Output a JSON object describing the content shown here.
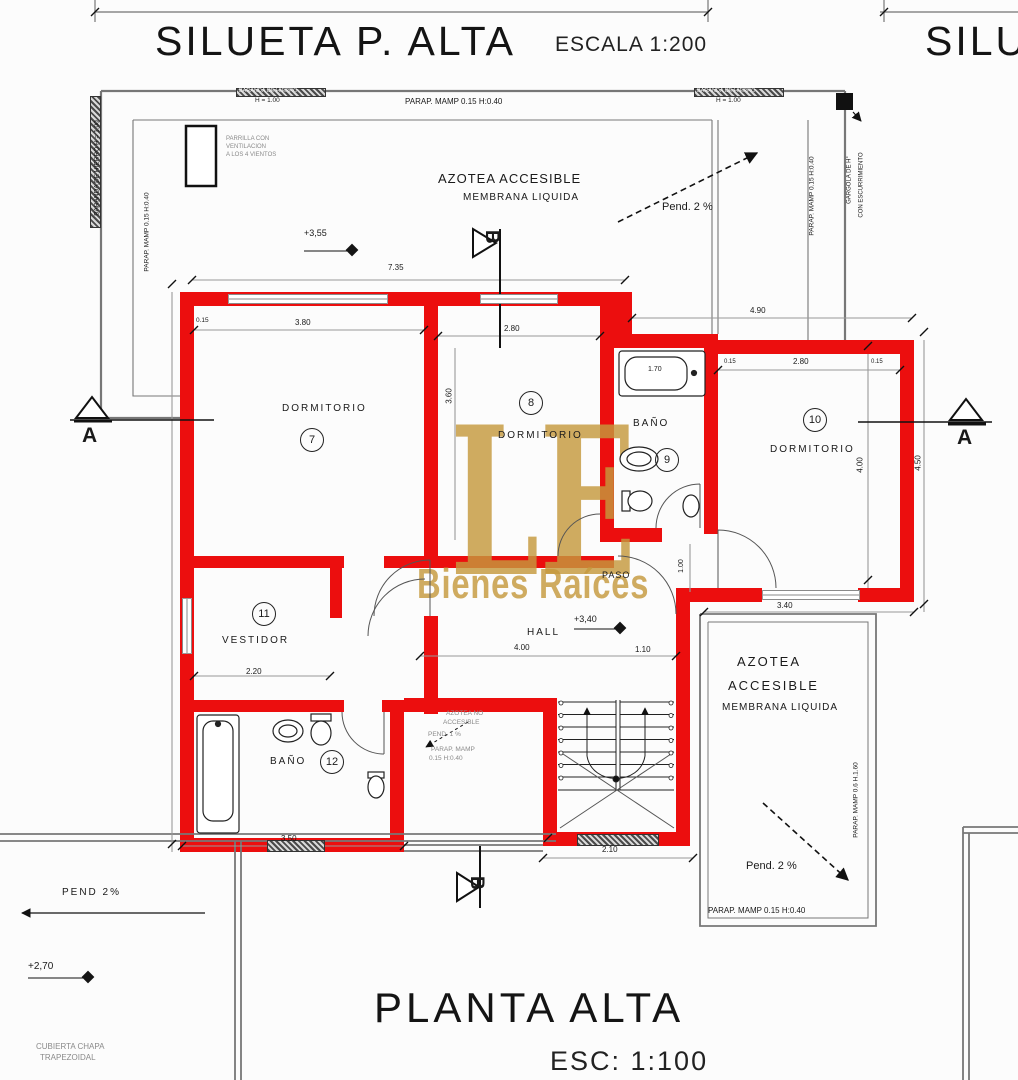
{
  "drawing": {
    "top_title": {
      "text": "SILUETA P. ALTA",
      "scale": "ESCALA 1:200"
    },
    "right_title_partial": "SILU",
    "bottom_title": {
      "text": "PLANTA ALTA",
      "scale": "ESC: 1:100"
    },
    "watermark": {
      "initials": "LE",
      "name": "Bienes Raíces"
    }
  },
  "colors": {
    "wall_red": "#ec0e0e",
    "watermark_gold": "rgba(197,152,61,0.82)",
    "dim_gray": "#8a8a8a"
  },
  "labels": [
    {
      "t": "DORMITORIO",
      "x": 282,
      "y": 403,
      "s": 10,
      "ls": 2,
      "n": "label-dormitorio-7"
    },
    {
      "t": "7",
      "x": 300,
      "y": 428,
      "s": 11,
      "cls": "circ",
      "n": "room-number-7"
    },
    {
      "t": "8",
      "x": 519,
      "y": 391,
      "s": 11,
      "cls": "circ",
      "n": "room-number-8"
    },
    {
      "t": "DORMITORIO",
      "x": 498,
      "y": 430,
      "s": 10,
      "ls": 2,
      "n": "label-dormitorio-8"
    },
    {
      "t": "BAÑO",
      "x": 633,
      "y": 418,
      "s": 10,
      "ls": 2,
      "n": "label-bano-9"
    },
    {
      "t": "9",
      "x": 655,
      "y": 448,
      "s": 11,
      "cls": "circ",
      "n": "room-number-9"
    },
    {
      "t": "10",
      "x": 803,
      "y": 408,
      "s": 11,
      "cls": "circ",
      "n": "room-number-10"
    },
    {
      "t": "DORMITORIO",
      "x": 770,
      "y": 444,
      "s": 10,
      "ls": 2,
      "n": "label-dormitorio-10"
    },
    {
      "t": "11",
      "x": 252,
      "y": 602,
      "s": 11,
      "cls": "circ",
      "n": "room-number-11"
    },
    {
      "t": "VESTIDOR",
      "x": 222,
      "y": 635,
      "s": 10,
      "ls": 2,
      "n": "label-vestidor"
    },
    {
      "t": "BAÑO",
      "x": 270,
      "y": 756,
      "s": 10,
      "ls": 2,
      "n": "label-bano-12"
    },
    {
      "t": "12",
      "x": 320,
      "y": 750,
      "s": 11,
      "cls": "circ",
      "n": "room-number-12"
    },
    {
      "t": "HALL",
      "x": 527,
      "y": 627,
      "s": 10,
      "ls": 2,
      "n": "label-hall"
    },
    {
      "t": "PASO",
      "x": 602,
      "y": 570,
      "s": 9,
      "ls": 1,
      "n": "label-paso"
    },
    {
      "t": "AZOTEA ACCESIBLE",
      "x": 438,
      "y": 172,
      "s": 13,
      "ls": 1,
      "n": "label-azotea-top"
    },
    {
      "t": "MEMBRANA LIQUIDA",
      "x": 463,
      "y": 192,
      "s": 10,
      "ls": 1,
      "n": "label-membrana-top"
    },
    {
      "t": "Pend. 2 %",
      "x": 662,
      "y": 201,
      "s": 11,
      "n": "label-pend-top"
    },
    {
      "t": "AZOTEA",
      "x": 737,
      "y": 655,
      "s": 13,
      "ls": 2,
      "n": "label-azotea-br-1"
    },
    {
      "t": "ACCESIBLE",
      "x": 728,
      "y": 679,
      "s": 13,
      "ls": 2,
      "n": "label-azotea-br-2"
    },
    {
      "t": "MEMBRANA LIQUIDA",
      "x": 722,
      "y": 702,
      "s": 10,
      "ls": 1,
      "n": "label-membrana-br"
    },
    {
      "t": "Pend. 2 %",
      "x": 746,
      "y": 860,
      "s": 11,
      "n": "label-pend-br"
    },
    {
      "t": "PEND 2%",
      "x": 62,
      "y": 887,
      "s": 10,
      "ls": 2,
      "n": "label-pend-left"
    },
    {
      "t": "AZOTEA NO",
      "x": 446,
      "y": 710,
      "s": 6.5,
      "cls": "gray",
      "n": "label-azotea-no-1"
    },
    {
      "t": "ACCESIBLE",
      "x": 443,
      "y": 719,
      "s": 6.5,
      "cls": "gray",
      "n": "label-azotea-no-2"
    },
    {
      "t": "PEND. 1 %",
      "x": 428,
      "y": 731,
      "s": 6.5,
      "cls": "gray",
      "n": "label-pend-small"
    },
    {
      "t": "PARAP. MAMP",
      "x": 431,
      "y": 746,
      "s": 6.5,
      "cls": "gray",
      "n": "label-parap-small-1"
    },
    {
      "t": "0.15  H:0.40",
      "x": 429,
      "y": 755,
      "s": 6.5,
      "cls": "gray",
      "n": "label-parap-small-2"
    },
    {
      "t": "BARANDA DE HIERRO",
      "x": 239,
      "y": 88,
      "s": 5.5,
      "cls": "band-txt",
      "n": "label-baranda-top-left"
    },
    {
      "t": "H = 1.00",
      "x": 255,
      "y": 97,
      "s": 6.5,
      "n": "label-h100-left"
    },
    {
      "t": "PARAP. MAMP 0.15  H:0.40",
      "x": 405,
      "y": 97,
      "s": 8,
      "n": "label-parap-top"
    },
    {
      "t": "BARANDA DE HIERRO",
      "x": 697,
      "y": 88,
      "s": 5.5,
      "cls": "band-txt",
      "n": "label-baranda-top-right"
    },
    {
      "t": "H = 1.00",
      "x": 716,
      "y": 97,
      "s": 6.5,
      "n": "label-h100-right"
    },
    {
      "t": "BARANDA DE HIERRO  H = 1.00",
      "x": 97,
      "y": 168,
      "s": 6.5,
      "cls": "rot",
      "n": "label-baranda-left"
    },
    {
      "t": "PARAP. MAMP 0.15  H:0.40",
      "x": 147,
      "y": 232,
      "s": 6.5,
      "cls": "rot",
      "n": "label-parap-left"
    },
    {
      "t": "PARAP. MAMP 0.15  H:0.40",
      "x": 812,
      "y": 196,
      "s": 6.5,
      "cls": "rot",
      "n": "label-parap-right"
    },
    {
      "t": "GARGOLA DE H°",
      "x": 850,
      "y": 180,
      "s": 6,
      "cls": "rot",
      "n": "label-gargola"
    },
    {
      "t": "CON ESCURRIMIENTO",
      "x": 862,
      "y": 185,
      "s": 6,
      "cls": "rot",
      "n": "label-escurrimiento"
    },
    {
      "t": "PARAP. MAMP 0.15  H:0.40",
      "x": 708,
      "y": 906,
      "s": 8,
      "n": "label-parap-br"
    },
    {
      "t": "PARAP. MAMP 0.6  H.1.60",
      "x": 856,
      "y": 800,
      "s": 6.5,
      "cls": "rot",
      "n": "label-parap-br-right"
    },
    {
      "t": "PARRILLA CON",
      "x": 226,
      "y": 136,
      "s": 6,
      "cls": "gray",
      "n": "label-parrilla-1"
    },
    {
      "t": "VENTILACION",
      "x": 226,
      "y": 144,
      "s": 6,
      "cls": "gray",
      "n": "label-parrilla-2"
    },
    {
      "t": "A LOS 4 VIENTOS",
      "x": 226,
      "y": 152,
      "s": 6,
      "cls": "gray",
      "n": "label-parrilla-3"
    },
    {
      "t": "CUBIERTA CHAPA",
      "x": 36,
      "y": 1042,
      "s": 8,
      "cls": "gray",
      "n": "label-cubierta-1"
    },
    {
      "t": "TRAPEZOIDAL",
      "x": 40,
      "y": 1053,
      "s": 8,
      "cls": "gray",
      "n": "label-cubierta-2"
    },
    {
      "t": "7.35",
      "x": 388,
      "y": 263,
      "s": 8,
      "n": "dim-7-35"
    },
    {
      "t": "4.90",
      "x": 750,
      "y": 306,
      "s": 8,
      "n": "dim-4-90"
    },
    {
      "t": "3.80",
      "x": 295,
      "y": 318,
      "s": 8,
      "n": "dim-3-80"
    },
    {
      "t": "0.15",
      "x": 196,
      "y": 317,
      "s": 6.5,
      "n": "dim-0-15-a"
    },
    {
      "t": "2.80",
      "x": 504,
      "y": 324,
      "s": 8,
      "n": "dim-2-80-d8"
    },
    {
      "t": "1.70",
      "x": 648,
      "y": 366,
      "s": 7,
      "n": "dim-1-70"
    },
    {
      "t": "2.80",
      "x": 793,
      "y": 357,
      "s": 8,
      "n": "dim-2-80-d10"
    },
    {
      "t": "0.15",
      "x": 724,
      "y": 359,
      "s": 6,
      "n": "dim-0-15-b"
    },
    {
      "t": "0.15",
      "x": 871,
      "y": 359,
      "s": 6,
      "n": "dim-0-15-c"
    },
    {
      "t": "3.40",
      "x": 777,
      "y": 601,
      "s": 8,
      "n": "dim-3-40"
    },
    {
      "t": "2.20",
      "x": 246,
      "y": 667,
      "s": 8,
      "n": "dim-2-20"
    },
    {
      "t": "3.50",
      "x": 281,
      "y": 834,
      "s": 8,
      "n": "dim-3-50"
    },
    {
      "t": "2.10",
      "x": 602,
      "y": 845,
      "s": 8,
      "n": "dim-2-10"
    },
    {
      "t": "4.00",
      "x": 514,
      "y": 643,
      "s": 8,
      "n": "dim-4-00-hall"
    },
    {
      "t": "1.10",
      "x": 635,
      "y": 645,
      "s": 8,
      "n": "dim-1-10"
    },
    {
      "t": "4.00",
      "x": 860,
      "y": 465,
      "s": 8,
      "cls": "rot",
      "n": "dim-4-00-d10"
    },
    {
      "t": "4.50",
      "x": 918,
      "y": 463,
      "s": 8,
      "cls": "rot",
      "n": "dim-4-50"
    },
    {
      "t": "3.60",
      "x": 449,
      "y": 396,
      "s": 8,
      "cls": "rot",
      "n": "dim-3-60"
    },
    {
      "t": "1.00",
      "x": 682,
      "y": 566,
      "s": 7,
      "cls": "rot",
      "n": "dim-1-00-paso"
    },
    {
      "t": "+3,55",
      "x": 304,
      "y": 228,
      "s": 9,
      "n": "level-3-55"
    },
    {
      "t": "+3,40",
      "x": 574,
      "y": 614,
      "s": 9,
      "n": "level-3-40"
    },
    {
      "t": "+2,70",
      "x": 28,
      "y": 961,
      "s": 10,
      "n": "level-2-70"
    },
    {
      "t": "A",
      "x": 82,
      "y": 424,
      "s": 21,
      "cls": "bold",
      "n": "section-a-left-label"
    },
    {
      "t": "A",
      "x": 957,
      "y": 426,
      "s": 21,
      "cls": "bold",
      "n": "section-a-right-label"
    },
    {
      "t": "B",
      "x": 502,
      "y": 230,
      "s": 19,
      "cls": "bold rot90",
      "n": "section-b-top-label"
    },
    {
      "t": "B",
      "x": 487,
      "y": 876,
      "s": 19,
      "cls": "bold rot90",
      "n": "section-b-bottom-label"
    }
  ],
  "walls": [
    [
      180,
      292,
      452,
      14
    ],
    [
      600,
      292,
      32,
      54
    ],
    [
      180,
      292,
      14,
      560
    ],
    [
      424,
      292,
      14,
      266
    ],
    [
      424,
      616,
      14,
      98
    ],
    [
      600,
      292,
      14,
      250
    ],
    [
      614,
      334,
      104,
      14
    ],
    [
      704,
      334,
      14,
      200
    ],
    [
      718,
      340,
      196,
      14
    ],
    [
      900,
      340,
      14,
      262
    ],
    [
      704,
      588,
      58,
      14
    ],
    [
      858,
      588,
      56,
      14
    ],
    [
      600,
      528,
      62,
      14
    ],
    [
      180,
      556,
      164,
      12
    ],
    [
      384,
      556,
      54,
      12
    ],
    [
      330,
      556,
      12,
      62
    ],
    [
      438,
      556,
      176,
      12
    ],
    [
      180,
      700,
      164,
      12
    ],
    [
      382,
      700,
      56,
      12
    ],
    [
      390,
      712,
      14,
      140
    ],
    [
      180,
      838,
      224,
      14
    ],
    [
      404,
      698,
      140,
      14
    ],
    [
      543,
      698,
      14,
      148
    ],
    [
      676,
      600,
      14,
      246
    ],
    [
      543,
      832,
      147,
      14
    ],
    [
      676,
      588,
      30,
      14
    ]
  ],
  "windows": [
    {
      "x": 228,
      "y": 294,
      "w": 158,
      "h": 10
    },
    {
      "x": 480,
      "y": 294,
      "w": 76,
      "h": 10
    },
    {
      "x": 762,
      "y": 590,
      "w": 96,
      "h": 10
    },
    {
      "x": 182,
      "y": 598,
      "w": 10,
      "h": 54,
      "v": 1
    }
  ],
  "bands": [
    {
      "x": 236,
      "y": 88,
      "w": 88,
      "h": 7
    },
    {
      "x": 694,
      "y": 88,
      "w": 88,
      "h": 7
    },
    {
      "x": 90,
      "y": 96,
      "w": 9,
      "h": 130
    },
    {
      "x": 577,
      "y": 834,
      "w": 80,
      "h": 10
    },
    {
      "x": 267,
      "y": 840,
      "w": 56,
      "h": 10
    }
  ],
  "diamonds": [
    {
      "x": 352,
      "y": 250
    },
    {
      "x": 620,
      "y": 628
    },
    {
      "x": 88,
      "y": 977
    }
  ]
}
